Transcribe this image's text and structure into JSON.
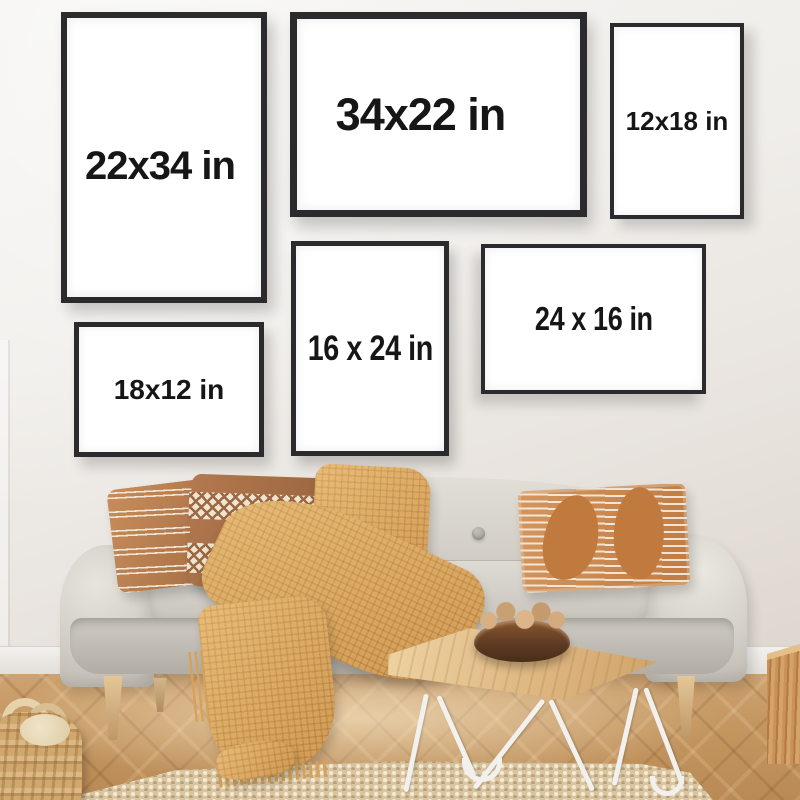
{
  "frames": [
    {
      "name": "frame-22x34",
      "label": "22x34 in"
    },
    {
      "name": "frame-34x22",
      "label": "34x22 in"
    },
    {
      "name": "frame-12x18",
      "label": "12x18 in"
    },
    {
      "name": "frame-16x24",
      "label": "16 x 24 in"
    },
    {
      "name": "frame-24x16",
      "label": "24 x 16 in"
    },
    {
      "name": "frame-18x12",
      "label": "18x12 in"
    }
  ],
  "colors": {
    "wall": "#ddd6ce",
    "frame": "#2b2b2d",
    "frame_mat": "#ffffff",
    "text": "#161616",
    "sofa": "#c5c1b9",
    "pillow_caramel": "#a06a40",
    "pillow_brown": "#96613c",
    "blanket": "#dca75f",
    "floor": "#c3955f",
    "rug": "#d9c5a2",
    "table_wood": "#dcb37c",
    "table_legs": "#f3f1ed",
    "bowl": "#5c3a22",
    "basket": "#bd9157"
  },
  "scene": {
    "objects": [
      "poster-frames-size-guide",
      "sofa",
      "striped-pillow",
      "diamond-pillow",
      "leaf-pattern-pillow",
      "waffle-knit-throw",
      "coffee-table",
      "wooden-bowl-with-nuts",
      "jute-rug",
      "woven-basket",
      "herringbone-floor",
      "baseboard",
      "wood-block-stool"
    ]
  }
}
